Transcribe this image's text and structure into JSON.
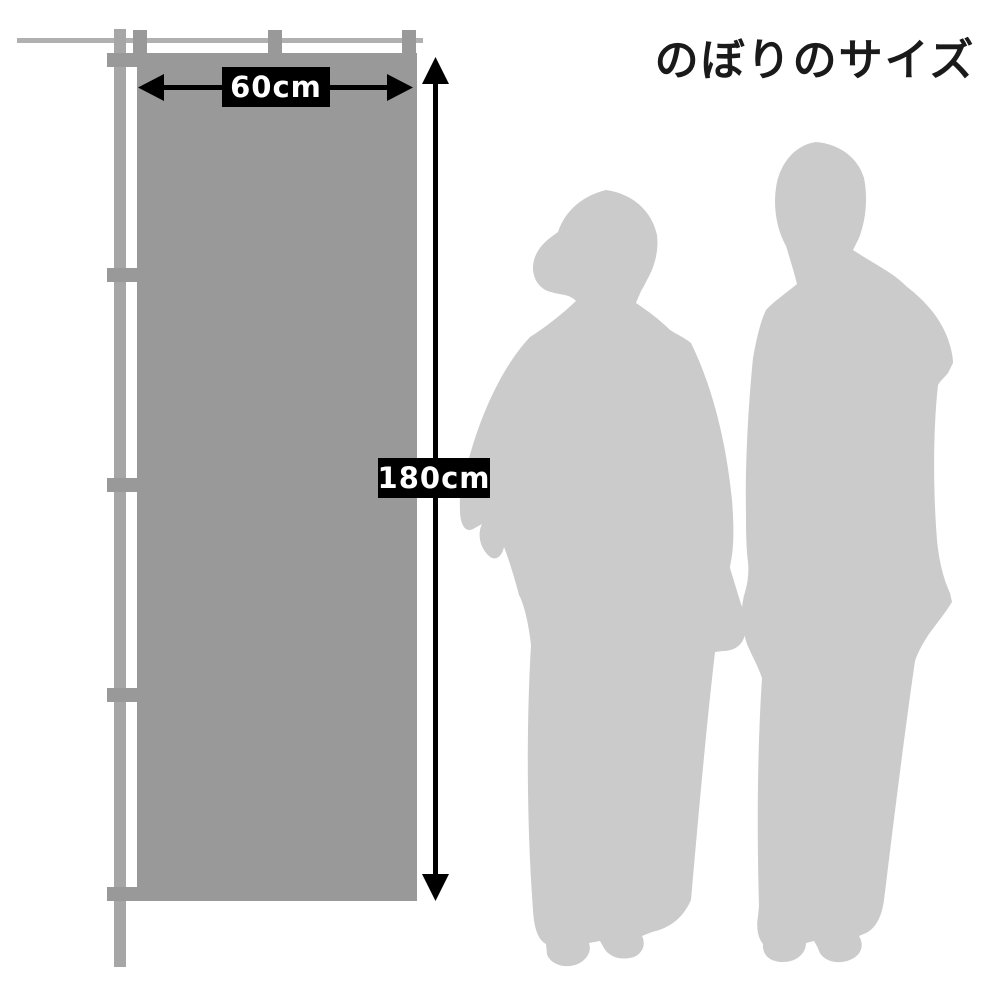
{
  "title": "のぼりのサイズ",
  "diagram": {
    "banner_width_label": "60cm",
    "banner_height_label": "180cm",
    "figures": {
      "left": "woman-in-kimono-silhouette",
      "right": "man-in-kimono-silhouette"
    }
  },
  "colors": {
    "background": "#ffffff",
    "banner": "#999999",
    "pole": "#a6a6a6",
    "rod": "#b0b0b0",
    "silhouette": "#cbcbcb",
    "arrow": "#000000",
    "label_bg": "#000000",
    "label_text": "#ffffff",
    "title_text": "#1a1a1a"
  }
}
